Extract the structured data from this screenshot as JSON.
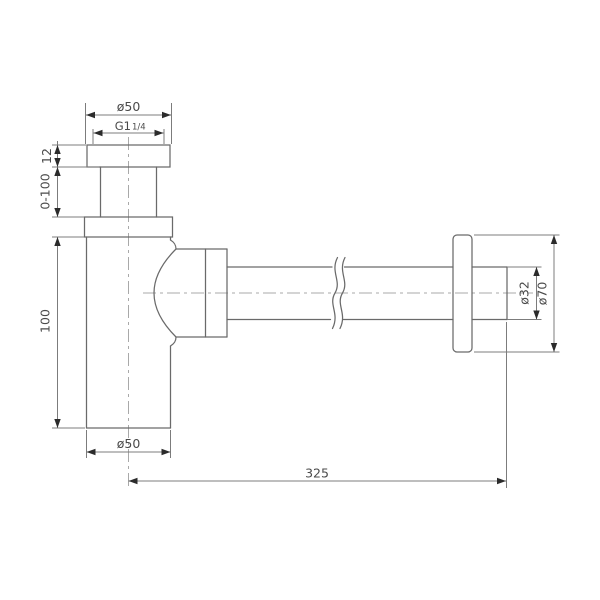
{
  "drawing": {
    "kind": "technical-dimension-drawing",
    "dimensions": {
      "top_diameter": "ø50",
      "thread_label": "G1",
      "thread_fraction": "1/4",
      "flange_height": "12",
      "adjustable_height": "0-100",
      "body_height": "100",
      "body_diameter": "ø50",
      "horizontal_length": "325",
      "pipe_diameter": "ø32",
      "wall_flange_diameter": "ø70"
    },
    "colors": {
      "background": "#ffffff",
      "outline": "#6a6a6a",
      "dimension_lines": "#7c7c7c",
      "centerline": "#a9a9a9",
      "text": "#4a4a4a",
      "arrow": "#2b2b2b"
    }
  }
}
